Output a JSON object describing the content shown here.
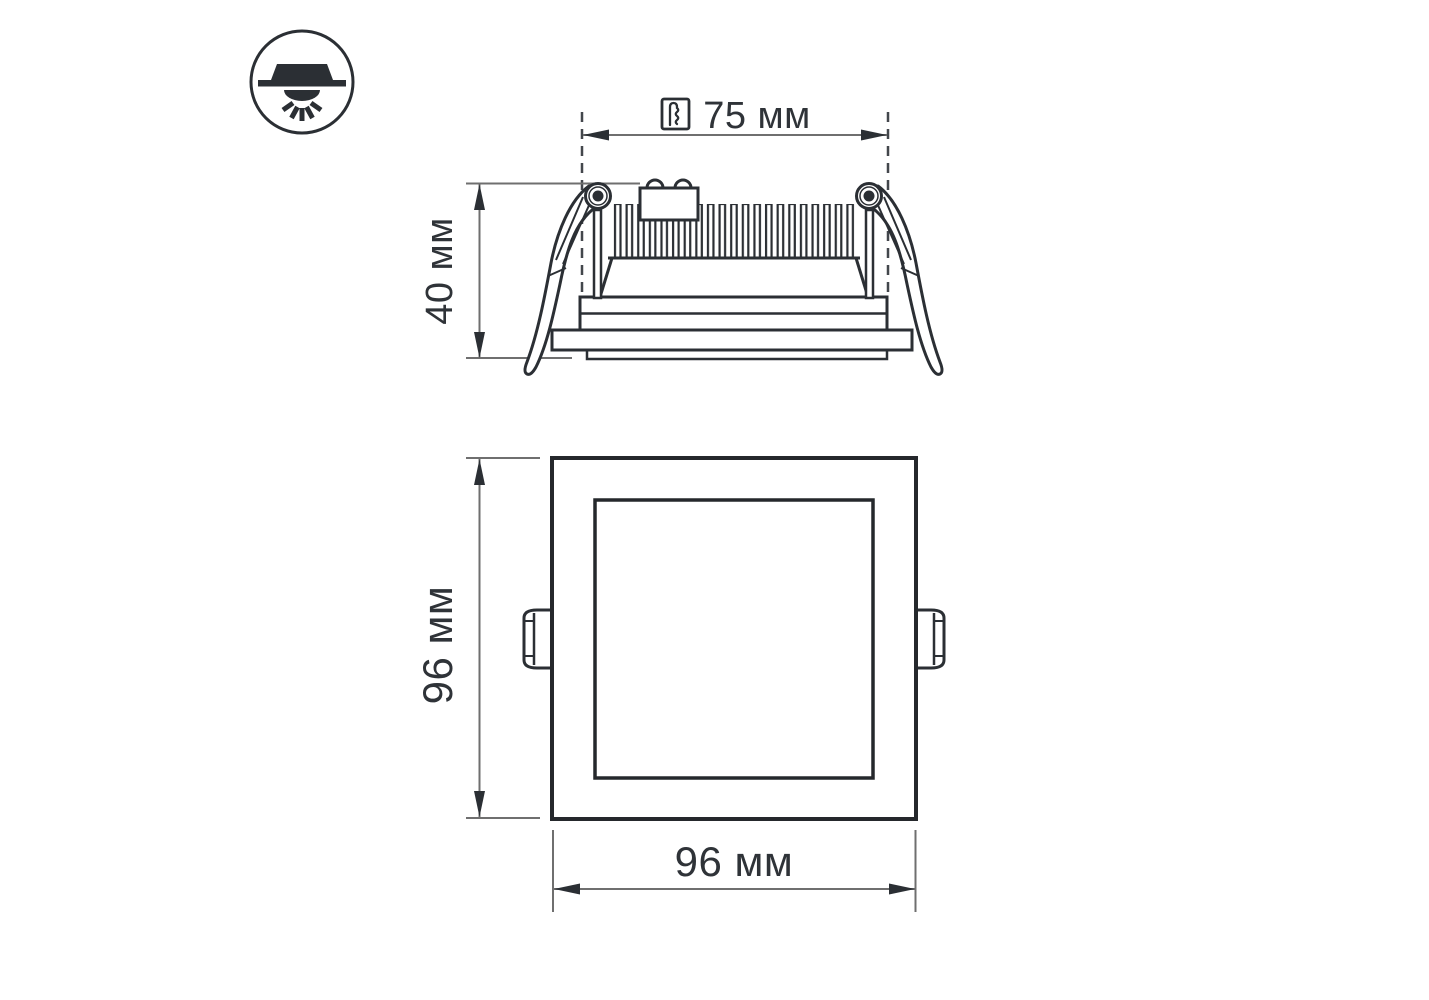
{
  "drawing": {
    "type": "technical-dimension-drawing",
    "views": {
      "side_view": {
        "cutout_label": "75 мм",
        "height_label": "40 мм"
      },
      "front_view": {
        "height_label": "96 мм",
        "width_label": "96 мм"
      }
    },
    "icons": {
      "legend": "recessed-downlight-icon",
      "cutout": "hole-saw-icon"
    },
    "colors": {
      "outline": "#2b2f34",
      "dimension_line": "#6f6f6f",
      "dashed_line": "#43474c",
      "text": "#2f3338",
      "background": "#ffffff"
    }
  }
}
